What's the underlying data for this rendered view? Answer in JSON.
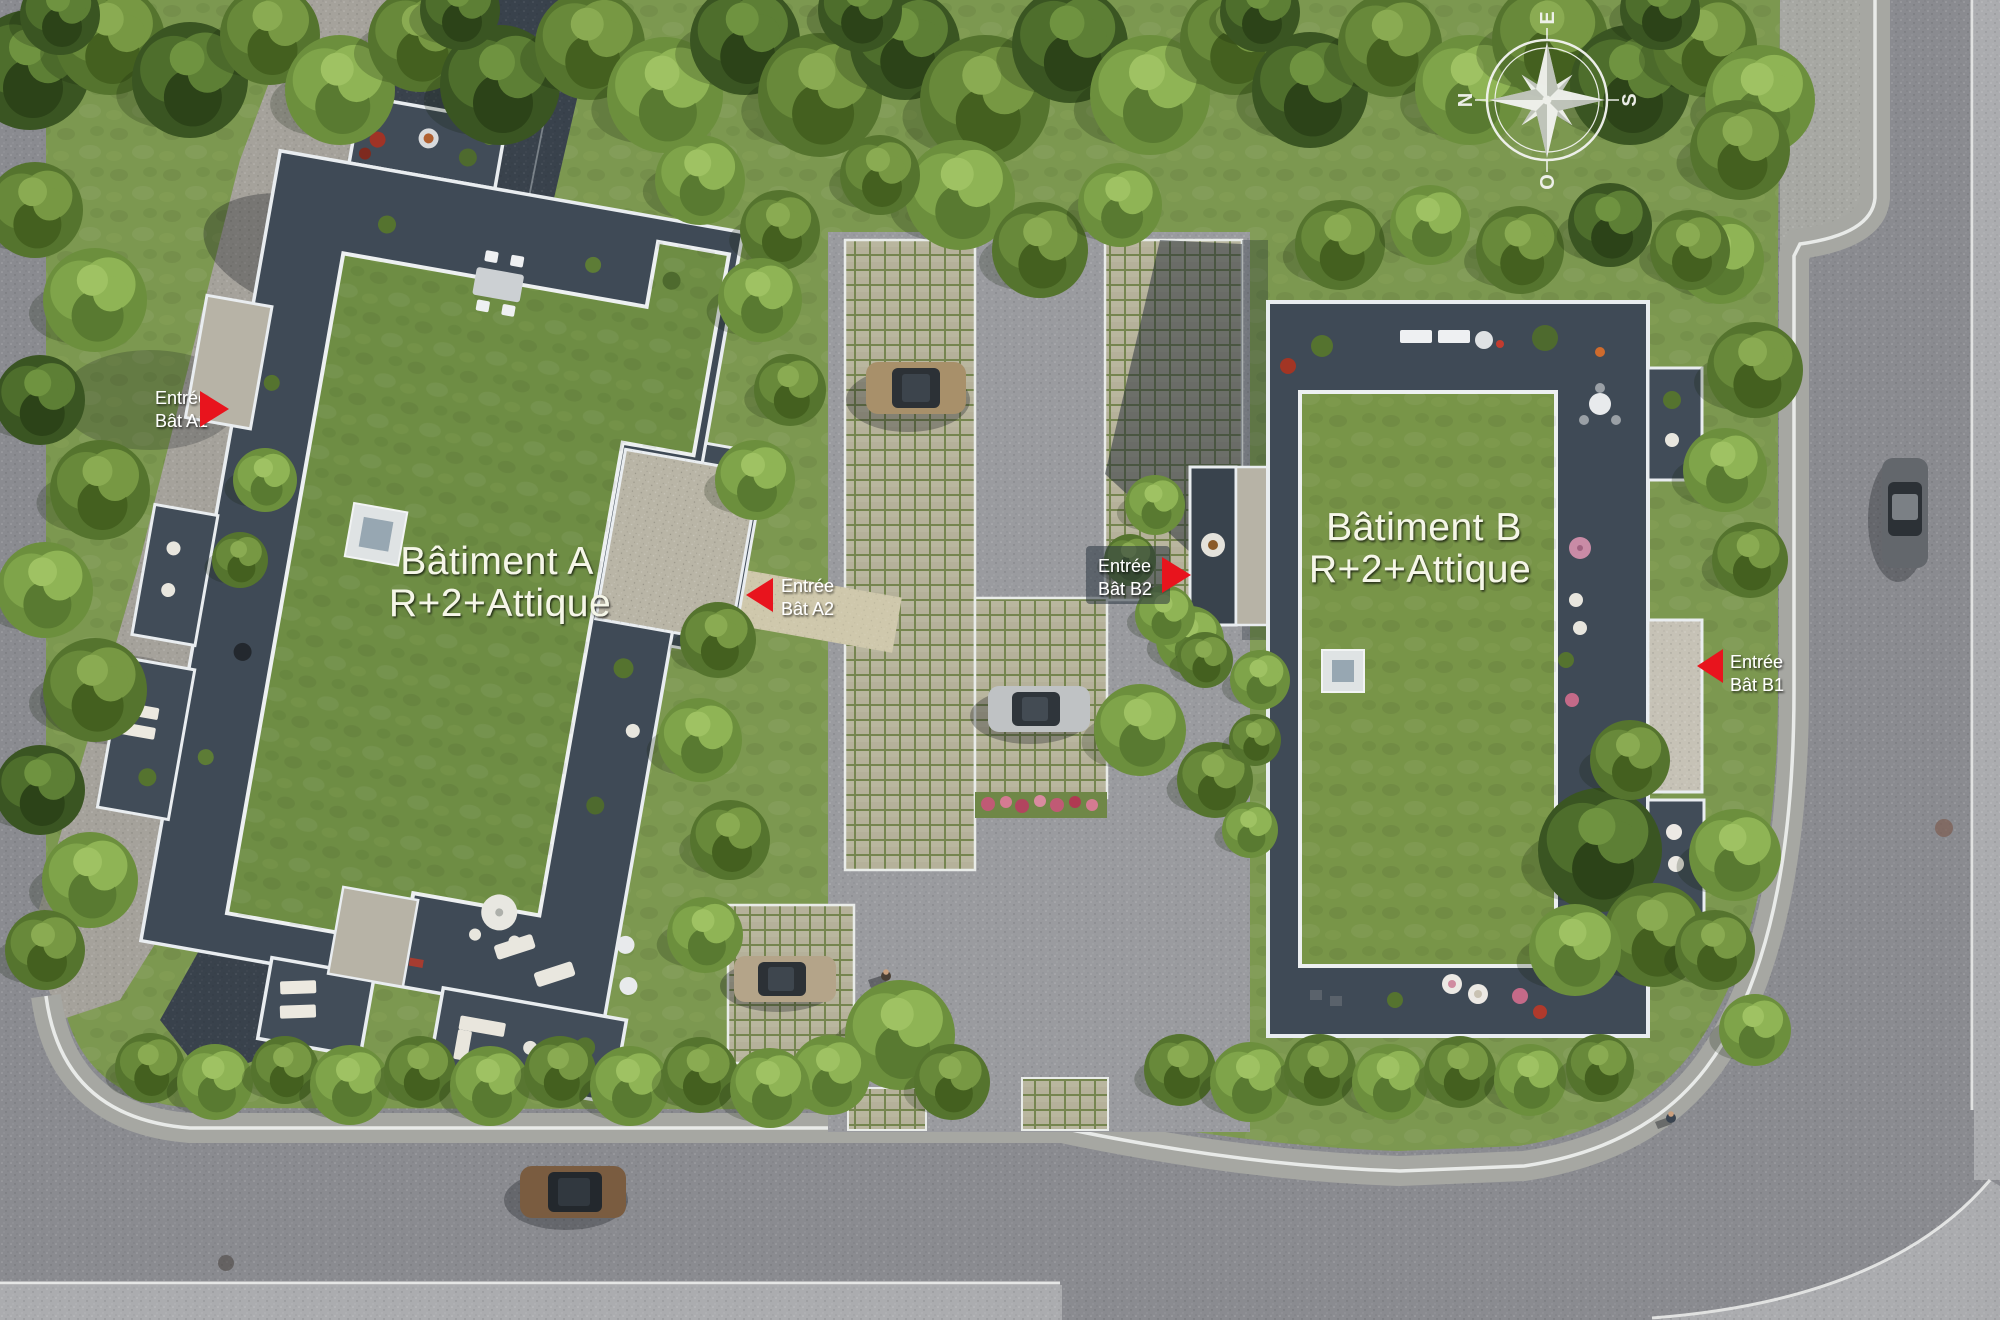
{
  "buildings": {
    "a": {
      "name": "Bâtiment A",
      "levels": "R+2+Attique"
    },
    "b": {
      "name": "Bâtiment B",
      "levels": "R+2+Attique"
    }
  },
  "entrances": [
    {
      "id": "A1",
      "label_line1": "Entrée",
      "label_line2": "Bât A1",
      "arrow_direction": "right"
    },
    {
      "id": "A2",
      "label_line1": "Entrée",
      "label_line2": "Bât A2",
      "arrow_direction": "left"
    },
    {
      "id": "B2",
      "label_line1": "Entrée",
      "label_line2": "Bât B2",
      "arrow_direction": "right"
    },
    {
      "id": "B1",
      "label_line1": "Entrée",
      "label_line2": "Bât B1",
      "arrow_direction": "left"
    }
  ],
  "compass": {
    "n": "N",
    "s": "S",
    "e": "E",
    "o": "O"
  },
  "colors": {
    "arrow_red": "#e8141d",
    "entrance_label_text": "#ffffff",
    "building_label_text": "#f5f6e8",
    "grass": "#7c9850",
    "roof_grass": "#6e8d44",
    "terrace_dark": "#3f4a56",
    "parapet_white": "#e9edf0",
    "road_asphalt": "#8a8b90",
    "paver_beige": "#b5b19a"
  }
}
